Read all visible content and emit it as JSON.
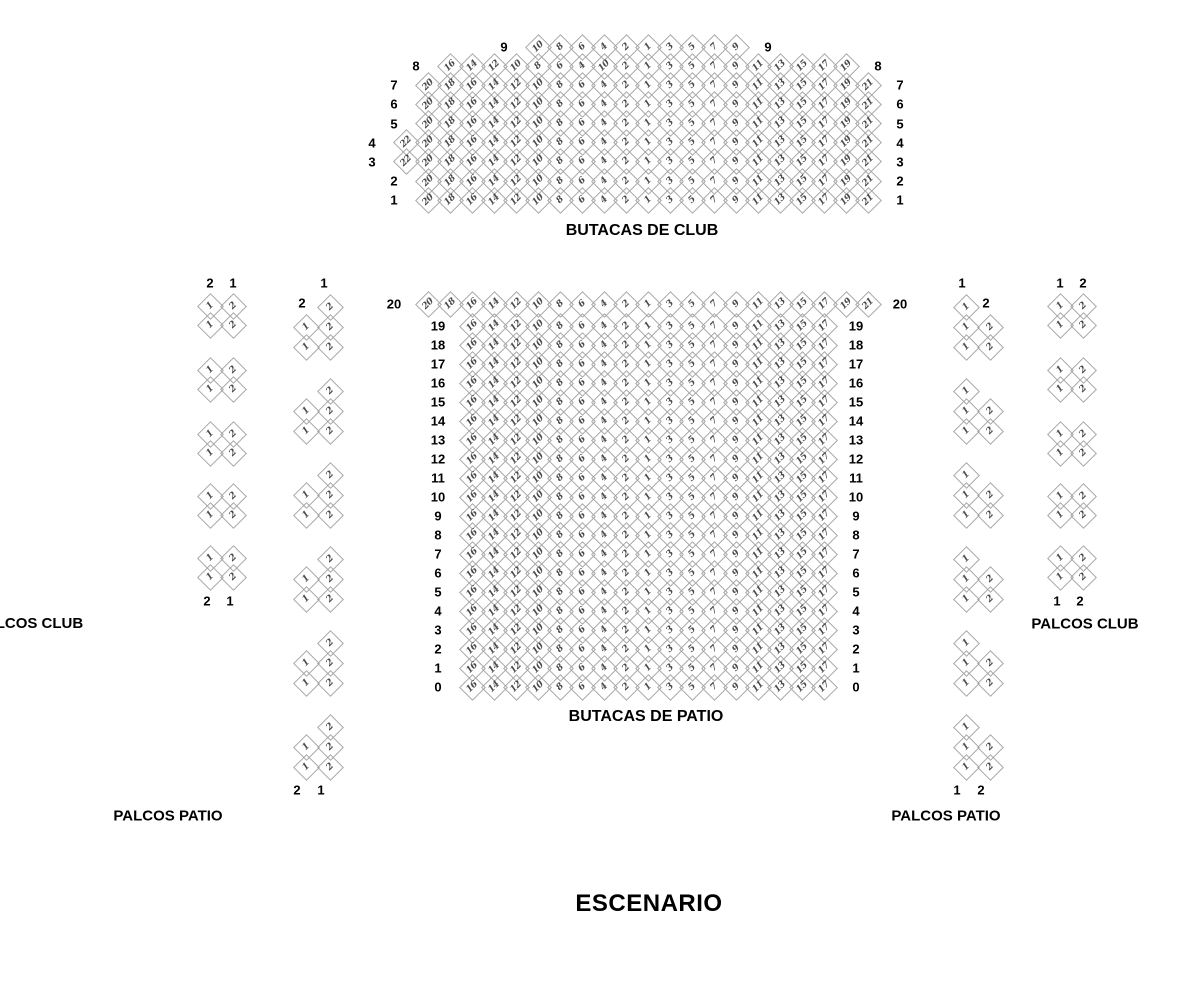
{
  "colors": {
    "background": "#ffffff",
    "seat_border": "#a6a6a6",
    "seat_number": "#4a4a4a",
    "label_text": "#000000"
  },
  "stage": {
    "label": "ESCENARIO"
  },
  "seat_sets": {
    "row_21": [
      20,
      18,
      16,
      14,
      12,
      10,
      8,
      6,
      4,
      2,
      1,
      3,
      5,
      7,
      9,
      11,
      13,
      15,
      17,
      19,
      21
    ],
    "row_22": [
      22,
      20,
      18,
      16,
      14,
      12,
      10,
      8,
      6,
      4,
      2,
      1,
      3,
      5,
      7,
      9,
      11,
      13,
      15,
      17,
      19,
      21
    ],
    "club_row_8": [
      16,
      14,
      12,
      10,
      8,
      6,
      4,
      10,
      2,
      1,
      3,
      5,
      7,
      9,
      11,
      13,
      15,
      17,
      19
    ],
    "club_row_9": [
      10,
      8,
      6,
      4,
      2,
      1,
      3,
      5,
      7,
      9
    ],
    "row_17": [
      16,
      14,
      12,
      10,
      8,
      6,
      4,
      2,
      1,
      3,
      5,
      7,
      9,
      11,
      13,
      15,
      17
    ]
  },
  "butacas_club": {
    "label": "BUTACAS DE CLUB",
    "rows": [
      {
        "row": "9",
        "set": "club_row_9",
        "start_col": 6
      },
      {
        "row": "8",
        "set": "club_row_8",
        "start_col": 2
      },
      {
        "row": "7",
        "set": "row_21",
        "start_col": 1
      },
      {
        "row": "6",
        "set": "row_21",
        "start_col": 1
      },
      {
        "row": "5",
        "set": "row_21",
        "start_col": 1
      },
      {
        "row": "4",
        "set": "row_22",
        "start_col": 0
      },
      {
        "row": "3",
        "set": "row_22",
        "start_col": 0
      },
      {
        "row": "2",
        "set": "row_21",
        "start_col": 1
      },
      {
        "row": "1",
        "set": "row_21",
        "start_col": 1
      }
    ]
  },
  "butacas_patio": {
    "label": "BUTACAS DE PATIO",
    "rows": [
      {
        "row": "20",
        "set": "row_21",
        "start_col": 1
      },
      {
        "row": "19",
        "set": "row_17",
        "start_col": 3
      },
      {
        "row": "18",
        "set": "row_17",
        "start_col": 3
      },
      {
        "row": "17",
        "set": "row_17",
        "start_col": 3
      },
      {
        "row": "16",
        "set": "row_17",
        "start_col": 3
      },
      {
        "row": "15",
        "set": "row_17",
        "start_col": 3
      },
      {
        "row": "14",
        "set": "row_17",
        "start_col": 3
      },
      {
        "row": "13",
        "set": "row_17",
        "start_col": 3
      },
      {
        "row": "12",
        "set": "row_17",
        "start_col": 3
      },
      {
        "row": "11",
        "set": "row_17",
        "start_col": 3
      },
      {
        "row": "10",
        "set": "row_17",
        "start_col": 3
      },
      {
        "row": "9",
        "set": "row_17",
        "start_col": 3
      },
      {
        "row": "8",
        "set": "row_17",
        "start_col": 3
      },
      {
        "row": "7",
        "set": "row_17",
        "start_col": 3
      },
      {
        "row": "6",
        "set": "row_17",
        "start_col": 3
      },
      {
        "row": "5",
        "set": "row_17",
        "start_col": 3
      },
      {
        "row": "4",
        "set": "row_17",
        "start_col": 3
      },
      {
        "row": "3",
        "set": "row_17",
        "start_col": 3
      },
      {
        "row": "2",
        "set": "row_17",
        "start_col": 3
      },
      {
        "row": "1",
        "set": "row_17",
        "start_col": 3
      },
      {
        "row": "0",
        "set": "row_17",
        "start_col": 3
      }
    ]
  },
  "palcos": [
    {
      "id": "left-club",
      "section_label": "PALCOS CLUB",
      "top_labels": [
        "2",
        "1"
      ],
      "bottom_labels": [
        "2",
        "1"
      ],
      "group_count": 5,
      "group_rows": [
        [
          1,
          2
        ],
        [
          1,
          2
        ]
      ]
    },
    {
      "id": "left-patio",
      "section_label": "PALCOS PATIO",
      "top_label": "1",
      "side_label": "2",
      "bottom_labels": [
        "2",
        "1"
      ],
      "group_count": 6,
      "group_rows": [
        [
          null,
          2
        ],
        [
          1,
          2
        ],
        [
          1,
          2
        ]
      ]
    },
    {
      "id": "right-club",
      "section_label": "PALCOS CLUB",
      "top_labels": [
        "1",
        "2"
      ],
      "bottom_labels": [
        "1",
        "2"
      ],
      "group_count": 5,
      "group_rows": [
        [
          1,
          2
        ],
        [
          1,
          2
        ]
      ]
    },
    {
      "id": "right-patio",
      "section_label": "PALCOS PATIO",
      "top_label": "1",
      "side_label": "2",
      "bottom_labels": [
        "1",
        "2"
      ],
      "group_count": 6,
      "group_rows": [
        [
          1,
          null
        ],
        [
          1,
          2
        ],
        [
          1,
          2
        ]
      ]
    }
  ]
}
